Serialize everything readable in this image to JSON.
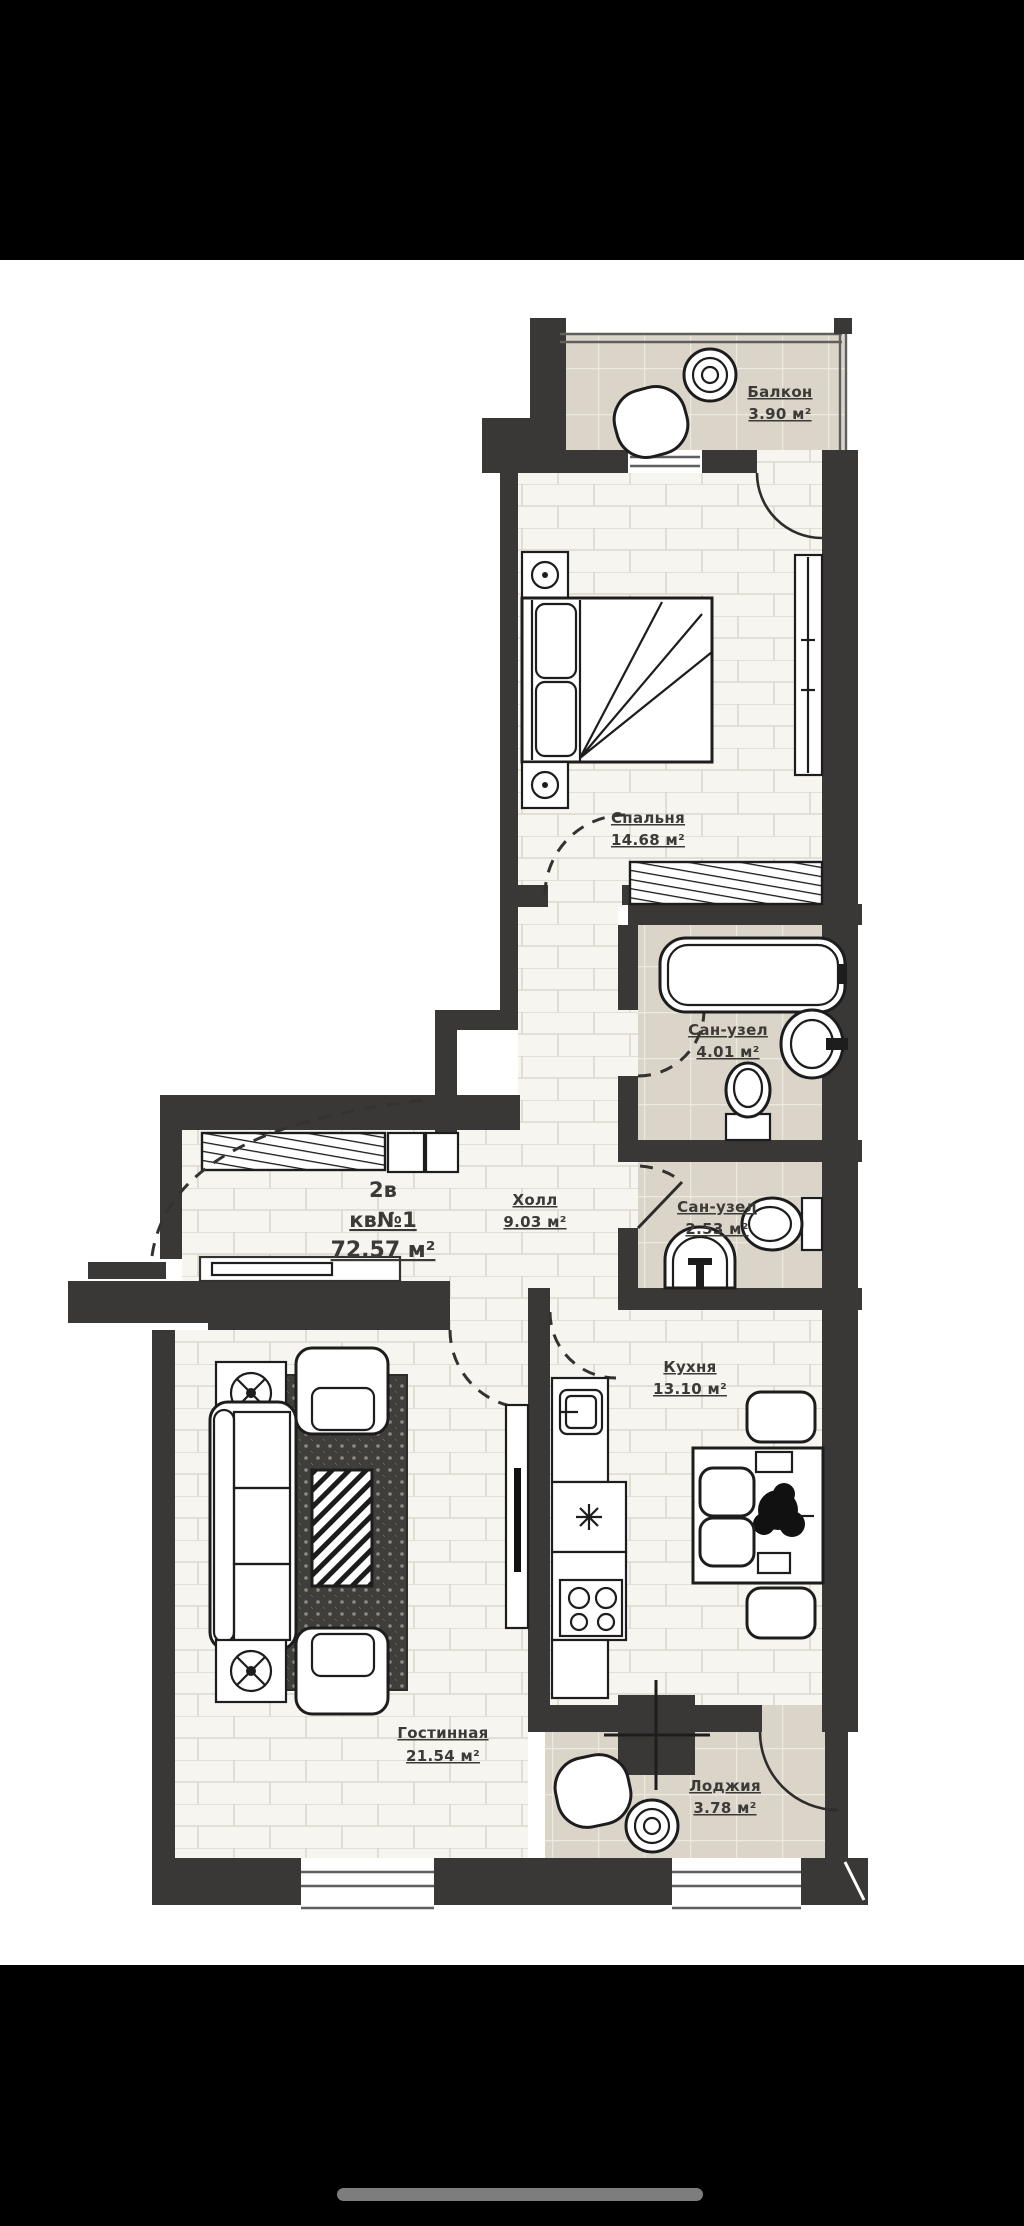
{
  "phone": {
    "top_bar_color": "#000000",
    "bottom_bar_color": "#000000",
    "home_indicator_color": "#7d7d7d"
  },
  "plan": {
    "apartment": {
      "type": "2в",
      "unit": "кв№1",
      "total_area": "72.57 м²"
    },
    "rooms": [
      {
        "id": "balcony",
        "name": "Балкон",
        "area": "3.90 м²"
      },
      {
        "id": "bedroom",
        "name": "Спальня",
        "area": "14.68 м²"
      },
      {
        "id": "bathroom_large",
        "name": "Сан-узел",
        "area": "4.01 м²"
      },
      {
        "id": "bathroom_small",
        "name": "Сан-узел",
        "area": "2.53 м²"
      },
      {
        "id": "hall",
        "name": "Холл",
        "area": "9.03 м²"
      },
      {
        "id": "kitchen",
        "name": "Кухня",
        "area": "13.10 м²"
      },
      {
        "id": "living_room",
        "name": "Гостинная",
        "area": "21.54 м²"
      },
      {
        "id": "loggia",
        "name": "Лоджия",
        "area": "3.78 м²"
      }
    ],
    "colors": {
      "wall": "#3a3836",
      "floor_brick": "#f6f5f0",
      "floor_tile": "#dbd5c9",
      "label": "#3c3a37"
    }
  }
}
